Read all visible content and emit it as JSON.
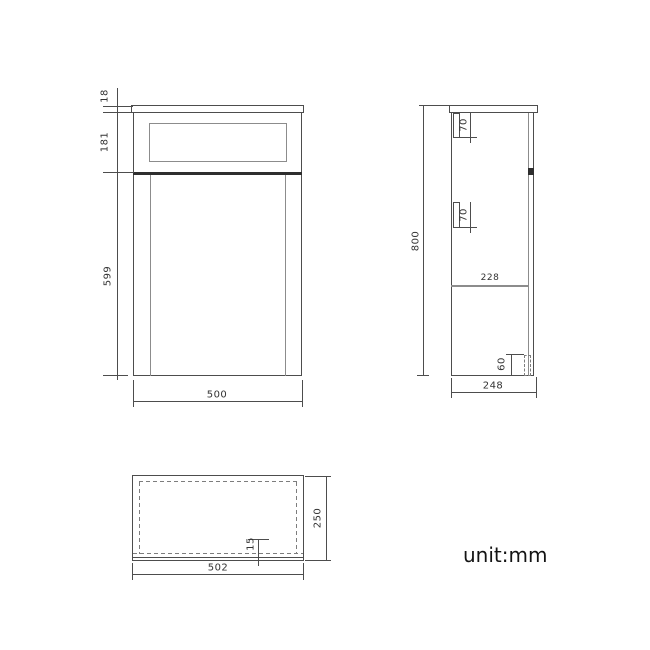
{
  "note": "unit:mm",
  "views": {
    "front": {
      "dims": {
        "top_thickness": "18",
        "drawer_height": "181",
        "door_height": "599",
        "width": "500"
      }
    },
    "side": {
      "dims": {
        "bracket_top": "70",
        "bracket_mid": "70",
        "inner_depth": "228",
        "height": "800",
        "plinth_height": "60",
        "depth": "248"
      }
    },
    "top": {
      "dims": {
        "front_edge": "15",
        "depth": "250",
        "width": "502"
      }
    }
  }
}
